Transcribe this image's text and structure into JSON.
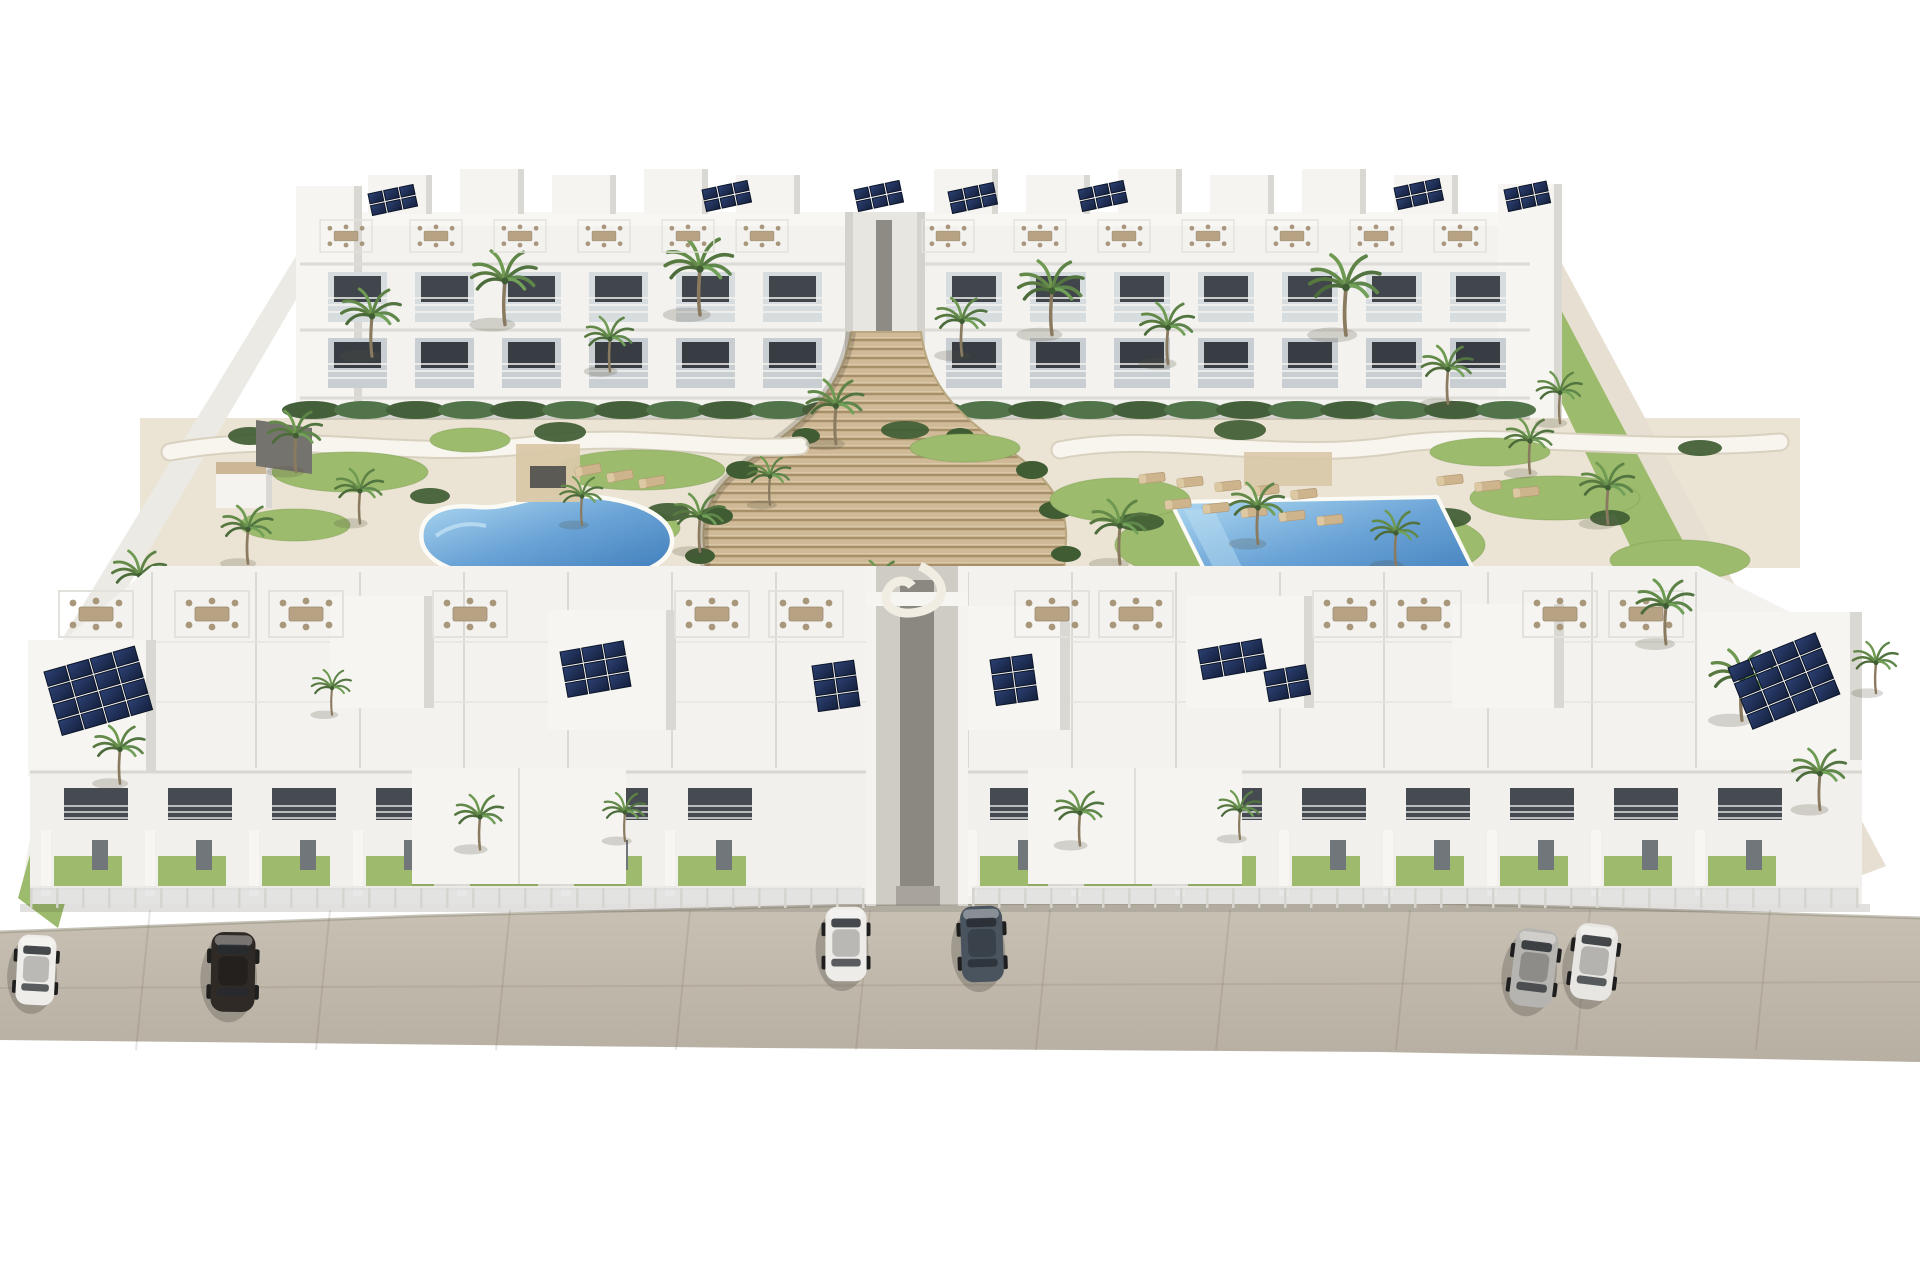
{
  "scene": {
    "type": "architectural-render",
    "description": "Aerial 3D rendering of a white Mediterranean apartment complex: rear apartment block and front townhouse row with rooftop terraces and solar panels, central wooden staircase, kidney-shaped pool, rectangular pool, sun loungers, palm trees, lawns, perimeter walls and six cars parked on the beige street in front"
  },
  "palette": {
    "background": "#ffffff",
    "street": "#c1bab0",
    "street_light": "#cdc6ba",
    "building_white": "#f3f2ef",
    "building_shade": "#dad8d2",
    "window_dark": "#3a3f45",
    "balcony_glass": "#d7dcdf",
    "deck_cream": "#ebe4d4",
    "path_white": "#f8f5ee",
    "stair_tan": "#cfb996",
    "stair_shadow": "#a78f68",
    "lawn_green": "#9dbb6c",
    "shrub_green": "#3f5c33",
    "pool_light": "#a6d4ef",
    "pool_deep": "#4c88c4",
    "solar_navy": "#1d2a47",
    "furniture_tan": "#b7a284",
    "car_white": "#efede9",
    "car_black": "#2f2a26",
    "car_slate": "#4a545f",
    "car_silver": "#b6b4b0"
  },
  "counts": {
    "pools": 2,
    "cars": 6,
    "building_rows": 2,
    "solar_arrays": 14
  },
  "objects": {
    "cars": [
      {
        "name": "white-car-left",
        "color": "#efede9",
        "x": 36,
        "y": 970,
        "rot": 3,
        "s": 0.92
      },
      {
        "name": "dark-sedan-left",
        "color": "#2f2a26",
        "x": 233,
        "y": 972,
        "rot": 1,
        "s": 1.05
      },
      {
        "name": "white-car-center",
        "color": "#eeece8",
        "x": 846,
        "y": 944,
        "rot": 0,
        "s": 0.98
      },
      {
        "name": "slate-sedan-center",
        "color": "#4a545f",
        "x": 982,
        "y": 944,
        "rot": -2,
        "s": 1.0
      },
      {
        "name": "silver-suv-right",
        "color": "#b6b4b0",
        "x": 1534,
        "y": 968,
        "rot": 7,
        "s": 1.02
      },
      {
        "name": "white-suv-right",
        "color": "#e8e6e2",
        "x": 1594,
        "y": 962,
        "rot": 7,
        "s": 1.0
      }
    ],
    "solar_arrays": [
      {
        "x": 368,
        "y": 194,
        "cols": 3,
        "rows": 2,
        "cw": 14,
        "ch": 10,
        "rot": -12
      },
      {
        "x": 702,
        "y": 190,
        "cols": 3,
        "rows": 2,
        "cw": 14,
        "ch": 10,
        "rot": -12
      },
      {
        "x": 854,
        "y": 190,
        "cols": 3,
        "rows": 2,
        "cw": 14,
        "ch": 10,
        "rot": -12
      },
      {
        "x": 948,
        "y": 192,
        "cols": 3,
        "rows": 2,
        "cw": 14,
        "ch": 10,
        "rot": -12
      },
      {
        "x": 1078,
        "y": 190,
        "cols": 3,
        "rows": 2,
        "cw": 14,
        "ch": 10,
        "rot": -12
      },
      {
        "x": 1394,
        "y": 188,
        "cols": 3,
        "rows": 2,
        "cw": 14,
        "ch": 10,
        "rot": -12
      },
      {
        "x": 1504,
        "y": 190,
        "cols": 3,
        "rows": 2,
        "cw": 13,
        "ch": 10,
        "rot": -12
      },
      {
        "x": 44,
        "y": 672,
        "cols": 4,
        "rows": 4,
        "cw": 22,
        "ch": 15,
        "rot": -16
      },
      {
        "x": 560,
        "y": 652,
        "cols": 3,
        "rows": 3,
        "cw": 20,
        "ch": 14,
        "rot": -10
      },
      {
        "x": 812,
        "y": 666,
        "cols": 2,
        "rows": 3,
        "cw": 20,
        "ch": 14,
        "rot": -8
      },
      {
        "x": 990,
        "y": 660,
        "cols": 2,
        "rows": 3,
        "cw": 20,
        "ch": 14,
        "rot": -8
      },
      {
        "x": 1198,
        "y": 650,
        "cols": 3,
        "rows": 2,
        "cw": 20,
        "ch": 14,
        "rot": -10
      },
      {
        "x": 1264,
        "y": 672,
        "cols": 2,
        "rows": 2,
        "cw": 20,
        "ch": 14,
        "rot": -10
      },
      {
        "x": 1728,
        "y": 668,
        "cols": 4,
        "rows": 4,
        "cw": 22,
        "ch": 15,
        "rot": -22
      }
    ],
    "palms_mid": [
      [
        372,
        352,
        1.05
      ],
      [
        505,
        320,
        1.15
      ],
      [
        610,
        368,
        0.85
      ],
      [
        700,
        310,
        1.2
      ],
      [
        836,
        440,
        1.0
      ],
      [
        962,
        352,
        0.9
      ],
      [
        1052,
        330,
        1.15
      ],
      [
        1168,
        360,
        0.95
      ],
      [
        1346,
        330,
        1.25
      ],
      [
        1448,
        400,
        0.9
      ],
      [
        1530,
        470,
        0.85
      ],
      [
        296,
        468,
        0.95
      ],
      [
        360,
        520,
        0.85
      ],
      [
        248,
        560,
        0.9
      ],
      [
        140,
        608,
        0.95
      ],
      [
        582,
        522,
        0.75
      ],
      [
        700,
        548,
        0.9
      ],
      [
        770,
        502,
        0.75
      ],
      [
        880,
        612,
        0.85
      ],
      [
        1120,
        560,
        1.0
      ],
      [
        1258,
        540,
        0.95
      ],
      [
        1396,
        562,
        0.85
      ],
      [
        1608,
        520,
        0.95
      ],
      [
        1560,
        420,
        0.8
      ]
    ],
    "palms_front": [
      [
        120,
        780,
        0.9
      ],
      [
        332,
        712,
        0.7
      ],
      [
        480,
        846,
        0.85
      ],
      [
        625,
        838,
        0.75
      ],
      [
        1080,
        842,
        0.85
      ],
      [
        1240,
        836,
        0.75
      ],
      [
        1666,
        640,
        1.0
      ],
      [
        1742,
        716,
        1.1
      ],
      [
        1820,
        806,
        0.95
      ],
      [
        1876,
        690,
        0.8
      ]
    ],
    "roof_furniture_back": {
      "y": 236,
      "scale": 0.7,
      "xs": [
        346,
        436,
        520,
        604,
        688,
        762,
        948,
        1040,
        1124,
        1208,
        1292,
        1376,
        1460
      ]
    },
    "roof_furniture_front": {
      "y": 614,
      "scale": 1.0,
      "xs": [
        96,
        212,
        306,
        470,
        712,
        806,
        1052,
        1136,
        1350,
        1424,
        1560,
        1646
      ]
    },
    "loungers": [
      [
        1152,
        478,
        -6
      ],
      [
        1190,
        482,
        -6
      ],
      [
        1228,
        486,
        -6
      ],
      [
        1266,
        490,
        -6
      ],
      [
        1304,
        494,
        -6
      ],
      [
        1178,
        504,
        -6
      ],
      [
        1216,
        508,
        -6
      ],
      [
        1254,
        512,
        -6
      ],
      [
        1292,
        516,
        -6
      ],
      [
        1330,
        520,
        -6
      ],
      [
        588,
        470,
        -10
      ],
      [
        620,
        476,
        -10
      ],
      [
        652,
        482,
        -10
      ],
      [
        1450,
        480,
        -6
      ],
      [
        1488,
        486,
        -6
      ],
      [
        1526,
        492,
        -6
      ]
    ],
    "lawn_blobs": [
      [
        350,
        472,
        78,
        20
      ],
      [
        640,
        470,
        85,
        20
      ],
      [
        295,
        525,
        55,
        16
      ],
      [
        610,
        528,
        70,
        22
      ],
      [
        1120,
        500,
        70,
        22
      ],
      [
        1300,
        545,
        185,
        46
      ],
      [
        1555,
        498,
        85,
        22
      ],
      [
        1680,
        560,
        70,
        20
      ],
      [
        470,
        440,
        40,
        12
      ],
      [
        965,
        448,
        55,
        14
      ],
      [
        1490,
        452,
        60,
        14
      ]
    ],
    "shrub_blobs": [
      [
        430,
        496,
        20,
        8
      ],
      [
        668,
        512,
        22,
        9
      ],
      [
        560,
        432,
        26,
        10
      ],
      [
        905,
        430,
        24,
        9
      ],
      [
        1140,
        522,
        24,
        9
      ],
      [
        1445,
        518,
        26,
        10
      ],
      [
        1240,
        430,
        26,
        10
      ],
      [
        1610,
        518,
        20,
        8
      ],
      [
        250,
        436,
        22,
        9
      ],
      [
        1700,
        448,
        22,
        8
      ],
      [
        902,
        600,
        14,
        7
      ],
      [
        940,
        586,
        12,
        6
      ]
    ],
    "hedges": [
      {
        "y": 410,
        "x0": 312,
        "x1": 836,
        "step": 52
      },
      {
        "y": 410,
        "x0": 934,
        "x1": 1514,
        "step": 52
      }
    ],
    "stair_bushes": [
      [
        742,
        470,
        16,
        9
      ],
      [
        716,
        516,
        17,
        9
      ],
      [
        700,
        556,
        15,
        8
      ],
      [
        1032,
        470,
        16,
        9
      ],
      [
        1056,
        510,
        17,
        9
      ],
      [
        1066,
        554,
        15,
        8
      ],
      [
        806,
        436,
        14,
        8
      ],
      [
        960,
        436,
        14,
        8
      ]
    ],
    "back_row_wings": [
      {
        "x0": 312,
        "x1": 838,
        "step": 87
      },
      {
        "x0": 930,
        "x1": 1516,
        "step": 84
      }
    ],
    "front_row_halves": [
      {
        "x0": 46,
        "x1": 860,
        "step": 104,
        "gx0": 152,
        "gx1": 866
      },
      {
        "x0": 972,
        "x1": 1852,
        "step": 104,
        "gx0": 968,
        "gx1": 1700
      }
    ],
    "fence": {
      "y": 888,
      "step": 26,
      "spans": [
        [
          30,
          862
        ],
        [
          972,
          1858
        ]
      ]
    },
    "street_seams": [
      150,
      330,
      510,
      690,
      870,
      1050,
      1230,
      1410,
      1590,
      1770
    ]
  }
}
